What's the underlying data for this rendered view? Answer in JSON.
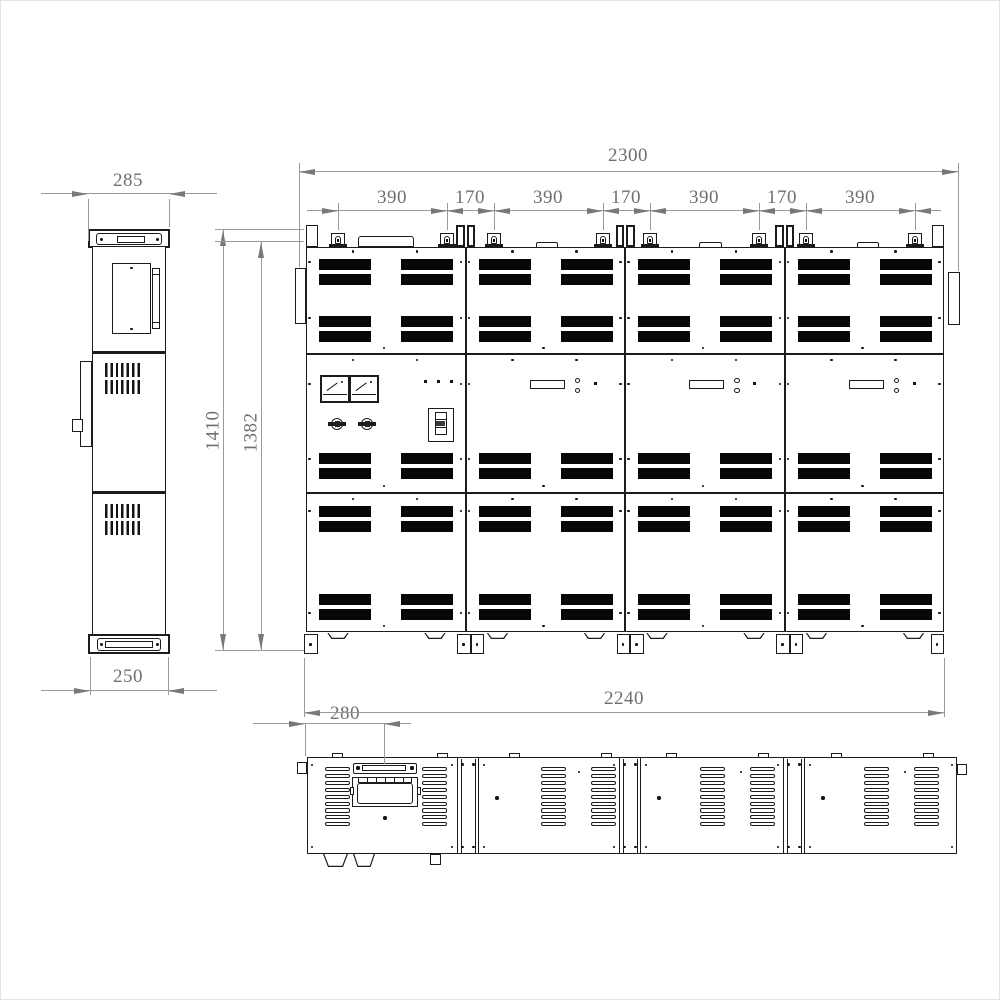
{
  "drawing": {
    "type": "three-view engineering drawing",
    "subject": "modular electrical cabinet lineup (side view, front view, top view)"
  },
  "colors": {
    "line": "#1c1c1c",
    "vent_fill": "#070707",
    "dim_line": "#9a9a9a",
    "dim_arrow": "#787878",
    "dim_text": "#6f6f6f",
    "background": "#ffffff"
  },
  "dimensions": {
    "side_top_width": "285",
    "side_bottom_width": "250",
    "front_total_width": "2300",
    "front_chain": [
      "390",
      "170",
      "390",
      "170",
      "390",
      "170",
      "390"
    ],
    "front_height_outer": "1410",
    "front_height_inner": "1382",
    "front_base_width": "2240",
    "top_view_offset": "280"
  }
}
